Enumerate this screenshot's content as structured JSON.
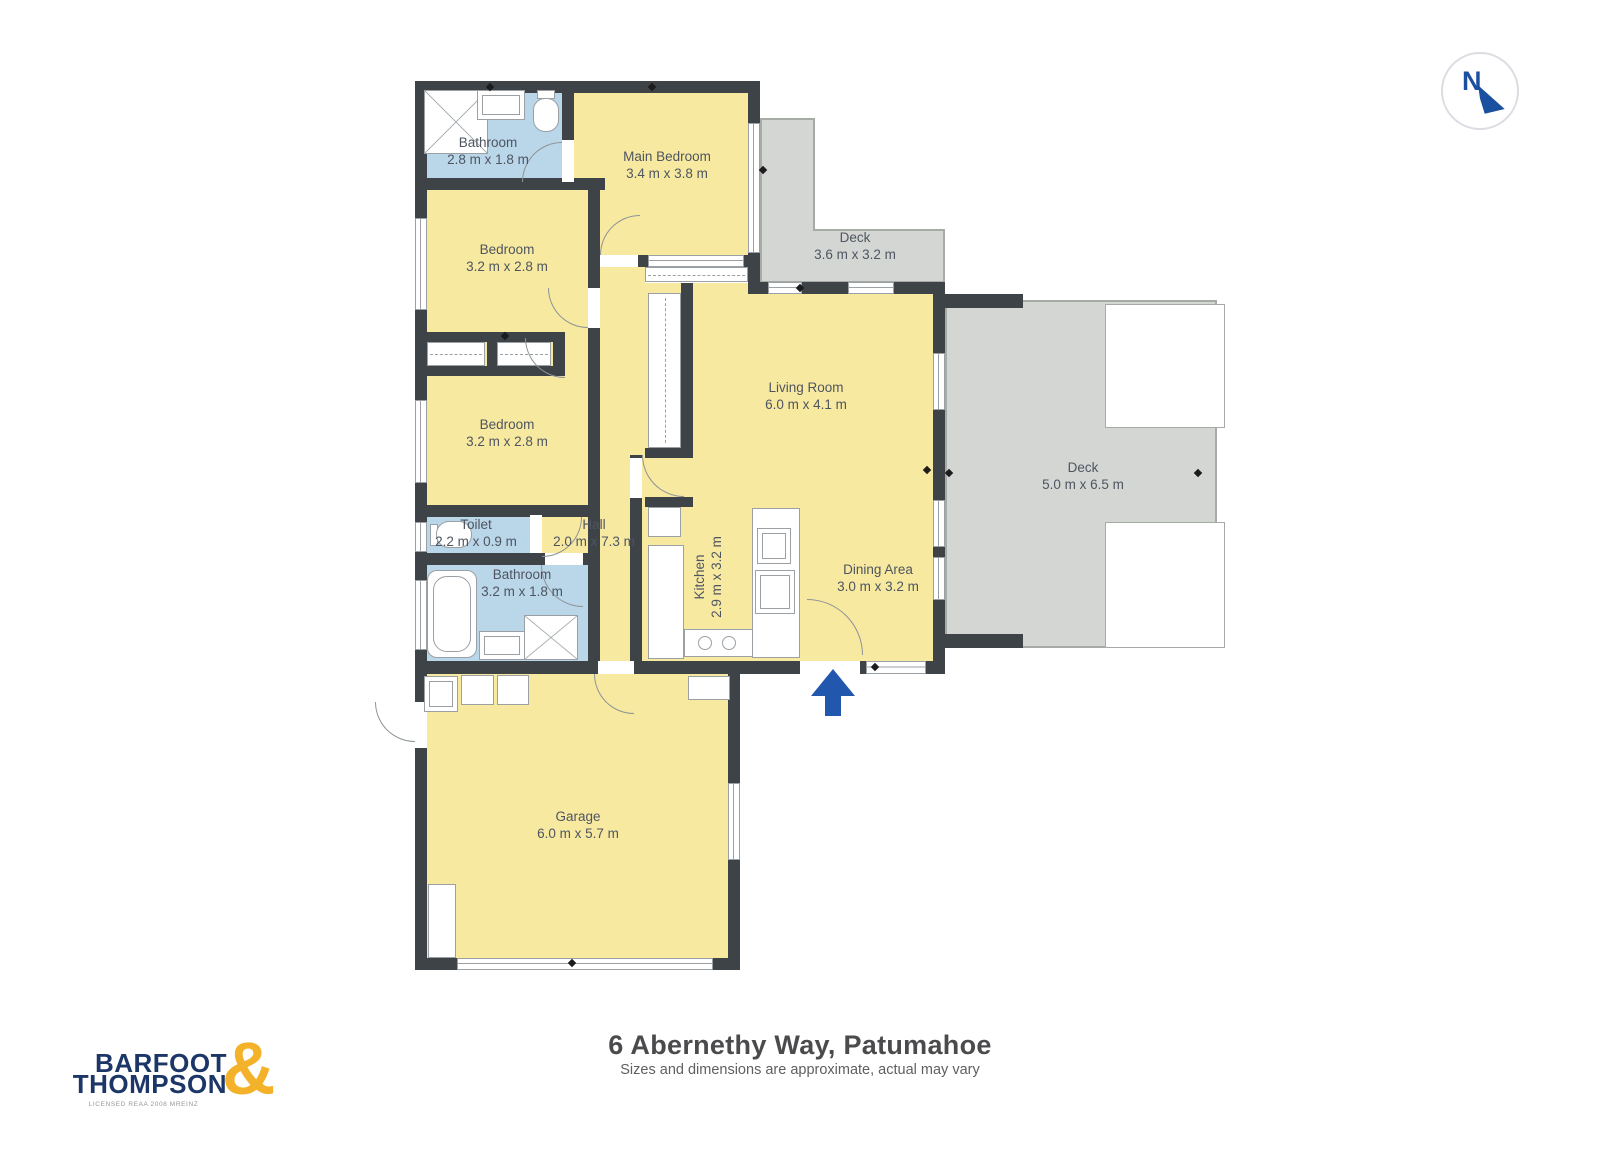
{
  "header": {
    "compass_letter": "N"
  },
  "rooms": [
    {
      "name": "Bathroom",
      "dims": "2.8 m x 1.8 m"
    },
    {
      "name": "Main Bedroom",
      "dims": "3.4 m x 3.8 m"
    },
    {
      "name": "Deck",
      "dims": "3.6 m x 3.2 m"
    },
    {
      "name": "Bedroom",
      "dims": "3.2 m x 2.8 m"
    },
    {
      "name": "Bedroom",
      "dims": "3.2 m x 2.8 m"
    },
    {
      "name": "Living Room",
      "dims": "6.0 m x 4.1 m"
    },
    {
      "name": "Deck",
      "dims": "5.0 m x 6.5 m"
    },
    {
      "name": "Toilet",
      "dims": "2.2 m x 0.9 m"
    },
    {
      "name": "Hall",
      "dims": "2.0 m x 7.3 m"
    },
    {
      "name": "Kitchen",
      "dims": "2.9 m x 3.2 m"
    },
    {
      "name": "Dining Area",
      "dims": "3.0 m x 3.2 m"
    },
    {
      "name": "Bathroom",
      "dims": "3.2 m x 1.8 m"
    },
    {
      "name": "Garage",
      "dims": "6.0 m x 5.7 m"
    }
  ],
  "footer": {
    "title": "6 Abernethy Way, Patumahoe",
    "subtitle": "Sizes and dimensions are approximate, actual may vary"
  },
  "logo": {
    "line1": "BARFOOT",
    "line2": "THOMPSON",
    "ampersand": "&",
    "caption": "LICENSED REAA 2008 MREINZ"
  },
  "colors": {
    "wall": "#3E4347",
    "floor_yellow": "#F8E9A1",
    "wet_area_blue": "#BAD6E9",
    "deck_gray": "#D4D6D3",
    "logo_navy": "#1C3767",
    "logo_gold": "#F3B229",
    "entrance_arrow_blue": "#2158AE"
  }
}
